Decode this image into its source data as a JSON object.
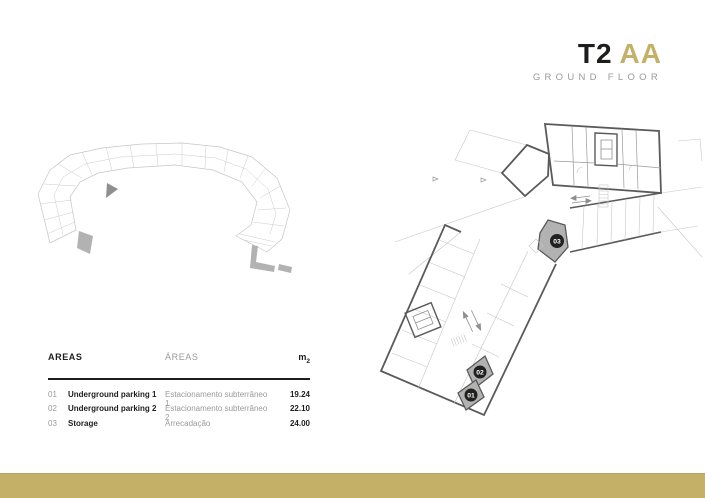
{
  "title": {
    "project_code": "T2",
    "typology_code": "AA",
    "floor_label": "GROUND FLOOR"
  },
  "colors": {
    "accent_gold": "#c4b167",
    "dark": "#1d1d1b",
    "gray_text": "#9a9a9a",
    "wall_dark": "#5a5a5a",
    "line_light": "#c6c6c6",
    "highlight_fill": "#b2b2b2",
    "highlight_dark": "#8f8f8f",
    "badge_bg": "#21211f",
    "badge_text": "#ffffff"
  },
  "areas_table": {
    "header": {
      "areas_en": "AREAS",
      "areas_pt": "ÁREAS",
      "unit_base": "m",
      "unit_sub": "2"
    },
    "rows": [
      {
        "number": "01",
        "name_en": "Underground parking 1",
        "name_pt": "Estacionamento subterrâneo 1",
        "area": "19.24"
      },
      {
        "number": "02",
        "name_en": "Underground parking 2",
        "name_pt": "Estacionamento subterrâneo 2",
        "area": "22.10"
      },
      {
        "number": "03",
        "name_en": "Storage",
        "name_pt": "Arrecadação",
        "area": "24.00"
      }
    ]
  },
  "floor_plan": {
    "badges": [
      {
        "label": "03"
      },
      {
        "label": "02"
      },
      {
        "label": "01"
      }
    ]
  }
}
